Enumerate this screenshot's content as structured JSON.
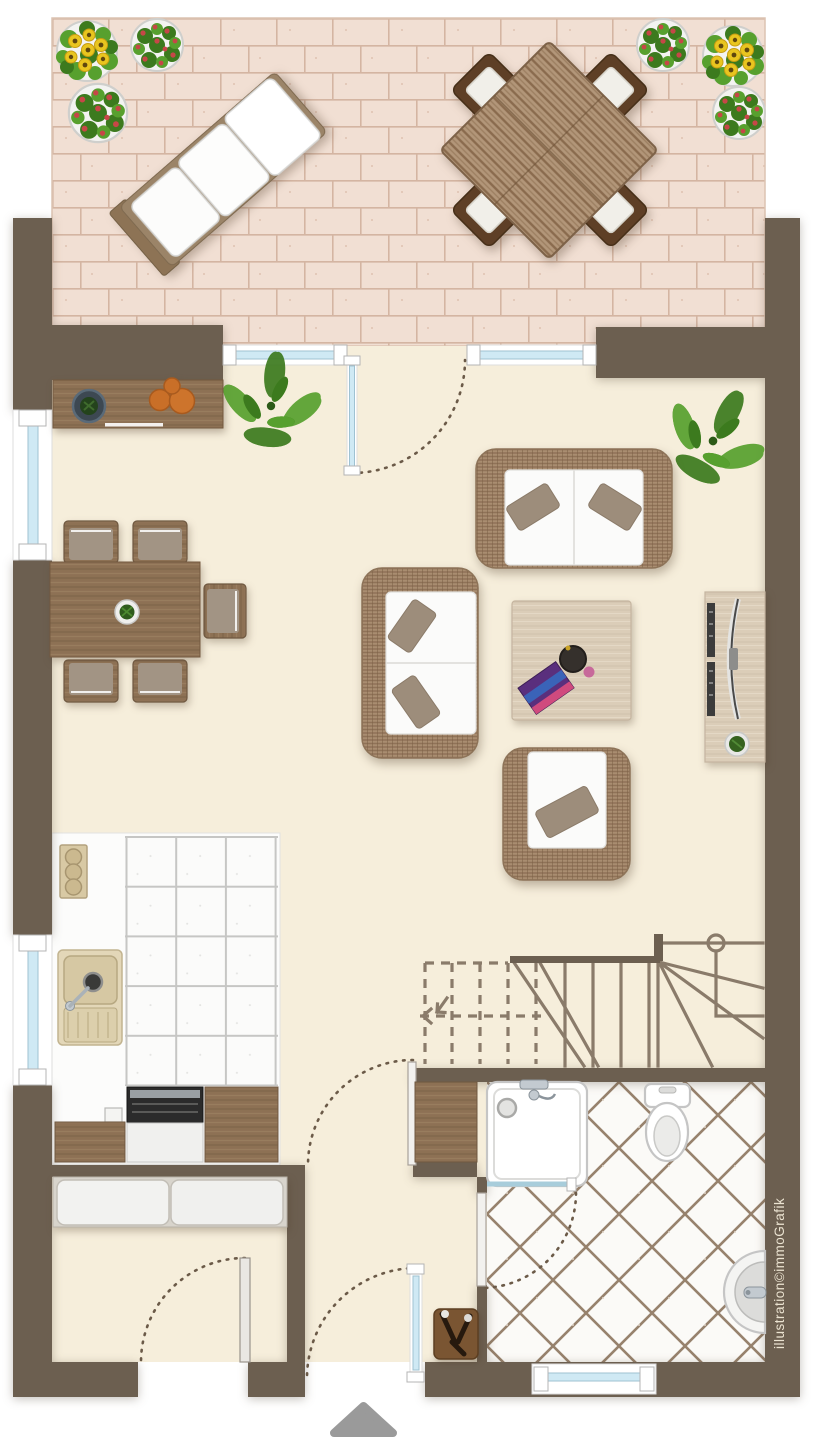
{
  "credit": {
    "text": "illustration©immoGrafik"
  },
  "entrance_marker": {
    "shape": "triangle-up",
    "color": "#9a9a9a"
  },
  "colors": {
    "outside": "#ffffff",
    "wall": "#6c5f50",
    "floor": "#f6eedb",
    "terrace_base": "#eedacd",
    "brick": "#f2e0d3",
    "brick_grout": "#d3b3a1",
    "glass": "#cfe9f4",
    "glass_frame": "#9fc2d2",
    "wood_mid": "#8d7154",
    "wood_dark": "#5e3f26",
    "wood_light": "#dbcdb8",
    "wicker": "#a98d70",
    "cushion_white": "#fbfbfa",
    "pillow": "#9d8d7b",
    "chair_cushion": "#a29484",
    "stair_line": "#8a7b6a",
    "tile_grout_kitchen": "#c6c6c4",
    "tile_grout_bath": "#97826d",
    "plant_green": "#57a02e",
    "plant_green_dark": "#3c7a1e",
    "sunflower": "#e9c51f",
    "flower_red": "#c64747",
    "marker_gray": "#9a9a9a",
    "fixture_stroke": "#c5c5c5",
    "arc_dot": "#6b5a48"
  },
  "areas": {
    "terrace": {
      "items": [
        "sun-lounger",
        "outdoor-dining-table",
        "outdoor-chair",
        "sunflower-pot",
        "red-flower-pot"
      ],
      "outdoor_chair_count": 4,
      "flower_pot_count": 6
    },
    "living_room": {
      "items": [
        "sideboard",
        "loveseat-sofa",
        "two-seat-sofa",
        "armchair",
        "coffee-table",
        "tv-sideboard",
        "potted-plant"
      ]
    },
    "dining_area": {
      "items": [
        "dining-table",
        "dining-chair",
        "table-plant"
      ],
      "chair_count": 5
    },
    "kitchen": {
      "items": [
        "cooktop",
        "kitchen-sink",
        "dishwasher",
        "wood-cabinet",
        "tiled-floor"
      ]
    },
    "staircase": {
      "type": "winder-stair-with-dashed-upper-flight"
    },
    "bathroom": {
      "items": [
        "shower",
        "toilet",
        "washbasin",
        "bath-cabinet",
        "diagonal-tiled-floor"
      ]
    },
    "hallway": {
      "items": [
        "entrance-door",
        "coat-stand"
      ]
    },
    "storage_room": {
      "items": [
        "wardrobe"
      ]
    }
  }
}
